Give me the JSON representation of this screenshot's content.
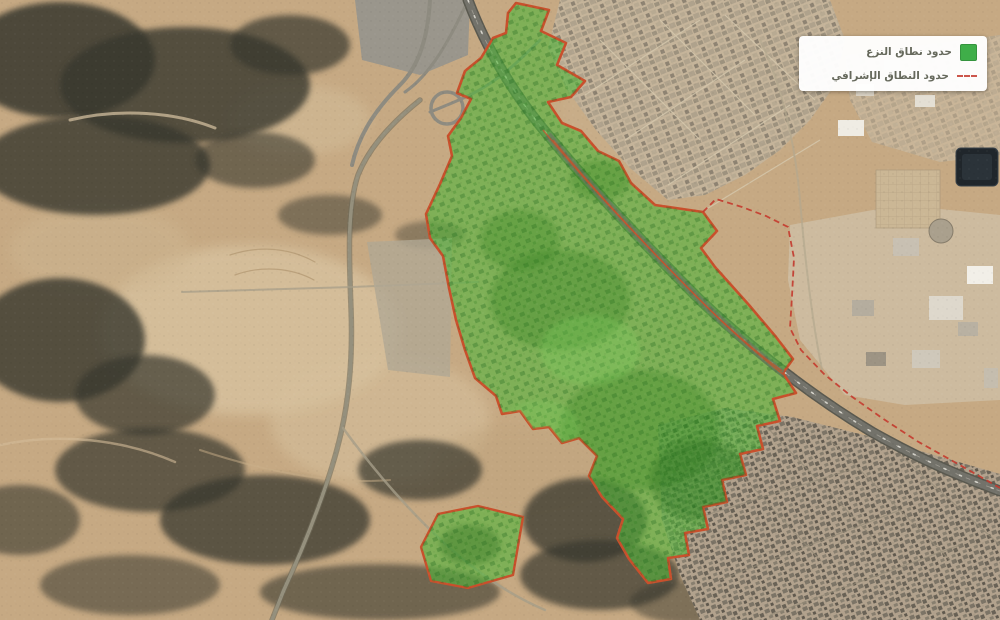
{
  "legend": {
    "items": [
      {
        "id": "expropriation-zone",
        "label": "حدود نطاق النزع",
        "swatch": "green-square"
      },
      {
        "id": "supervisory-boundary",
        "label": "حدود النطاق الإشرافي",
        "swatch": "red-dashed-line"
      }
    ]
  },
  "map": {
    "features": [
      "expropriation-zone-polygon",
      "expropriation-zone-sub-polygon",
      "supervisory-boundary-dashed-line",
      "highway",
      "interchange",
      "urban-area-northeast",
      "urban-area-southeast",
      "industrial-area-east",
      "rocky-terrain-west",
      "desert-terrain"
    ]
  },
  "colors": {
    "zone-fill": "#54b43c",
    "zone-border": "#c9502c",
    "supervisory-line": "#c43a2e",
    "legend-green": "#3fae49",
    "desert-base": "#c6a983",
    "rock-dark": "#38372e",
    "urban-tone": "#c5b49a",
    "highway-gray": "#73726a"
  }
}
